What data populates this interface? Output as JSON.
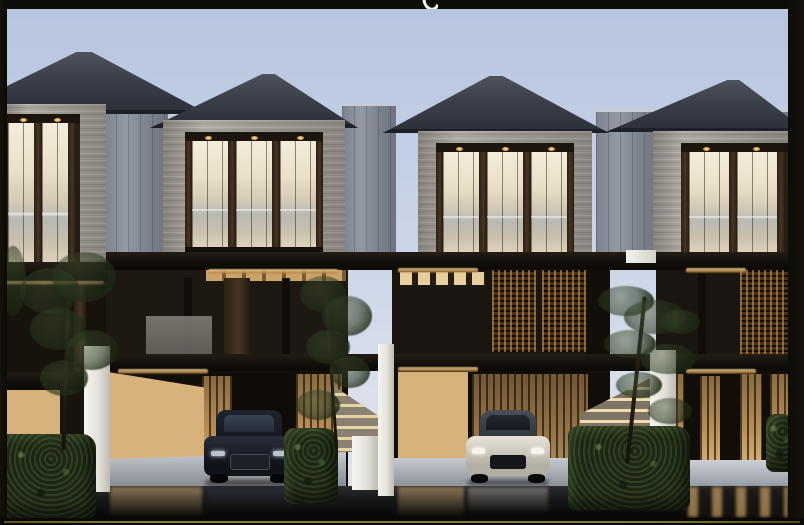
{
  "image": {
    "kind": "3d-architectural-exterior-rendering",
    "subject": "row of modern three-storey townhouses at dusk with warm interior lighting",
    "units_visible": 4,
    "storeys_per_unit": 3,
    "features": [
      "dark hip roofs",
      "stone-clad third-floor balconies with timber mullions",
      "black slab fascia bands with cove lighting",
      "floor-to-ceiling warm-lit glazing",
      "brown lattice privacy screens",
      "backlit timber slat carport walls",
      "white party walls and external stone stairs",
      "boxed hedges and slender trees",
      "wet reflective foreground"
    ],
    "cars": [
      {
        "type": "suv",
        "color": "dark navy",
        "location": "second-unit carport"
      },
      {
        "type": "sports-car",
        "color": "silver",
        "location": "third-unit carport"
      }
    ],
    "frame": {
      "style": "dark photo border",
      "bottom_accent": "thin olive-gold line",
      "top_edge_artifact": "white descender of a cropped caption letter"
    }
  },
  "palette": {
    "sky_top": "#b7c4df",
    "sky_bottom": "#dfe2ec",
    "roof": "#3a3f49",
    "stone": "#a49f97",
    "metal_wall": "#868c96",
    "fascia_black": "#120e09",
    "glazing_warm": "#f0e6d2",
    "timber_warm": "#d7b27c",
    "timber_dark": "#3d2d1f",
    "white_wall": "#efeee9",
    "foliage": "#2c3a22",
    "reflection_ground": "#0b0c0a",
    "frame_border": "#0d0c08",
    "accent_line": "#847634"
  }
}
